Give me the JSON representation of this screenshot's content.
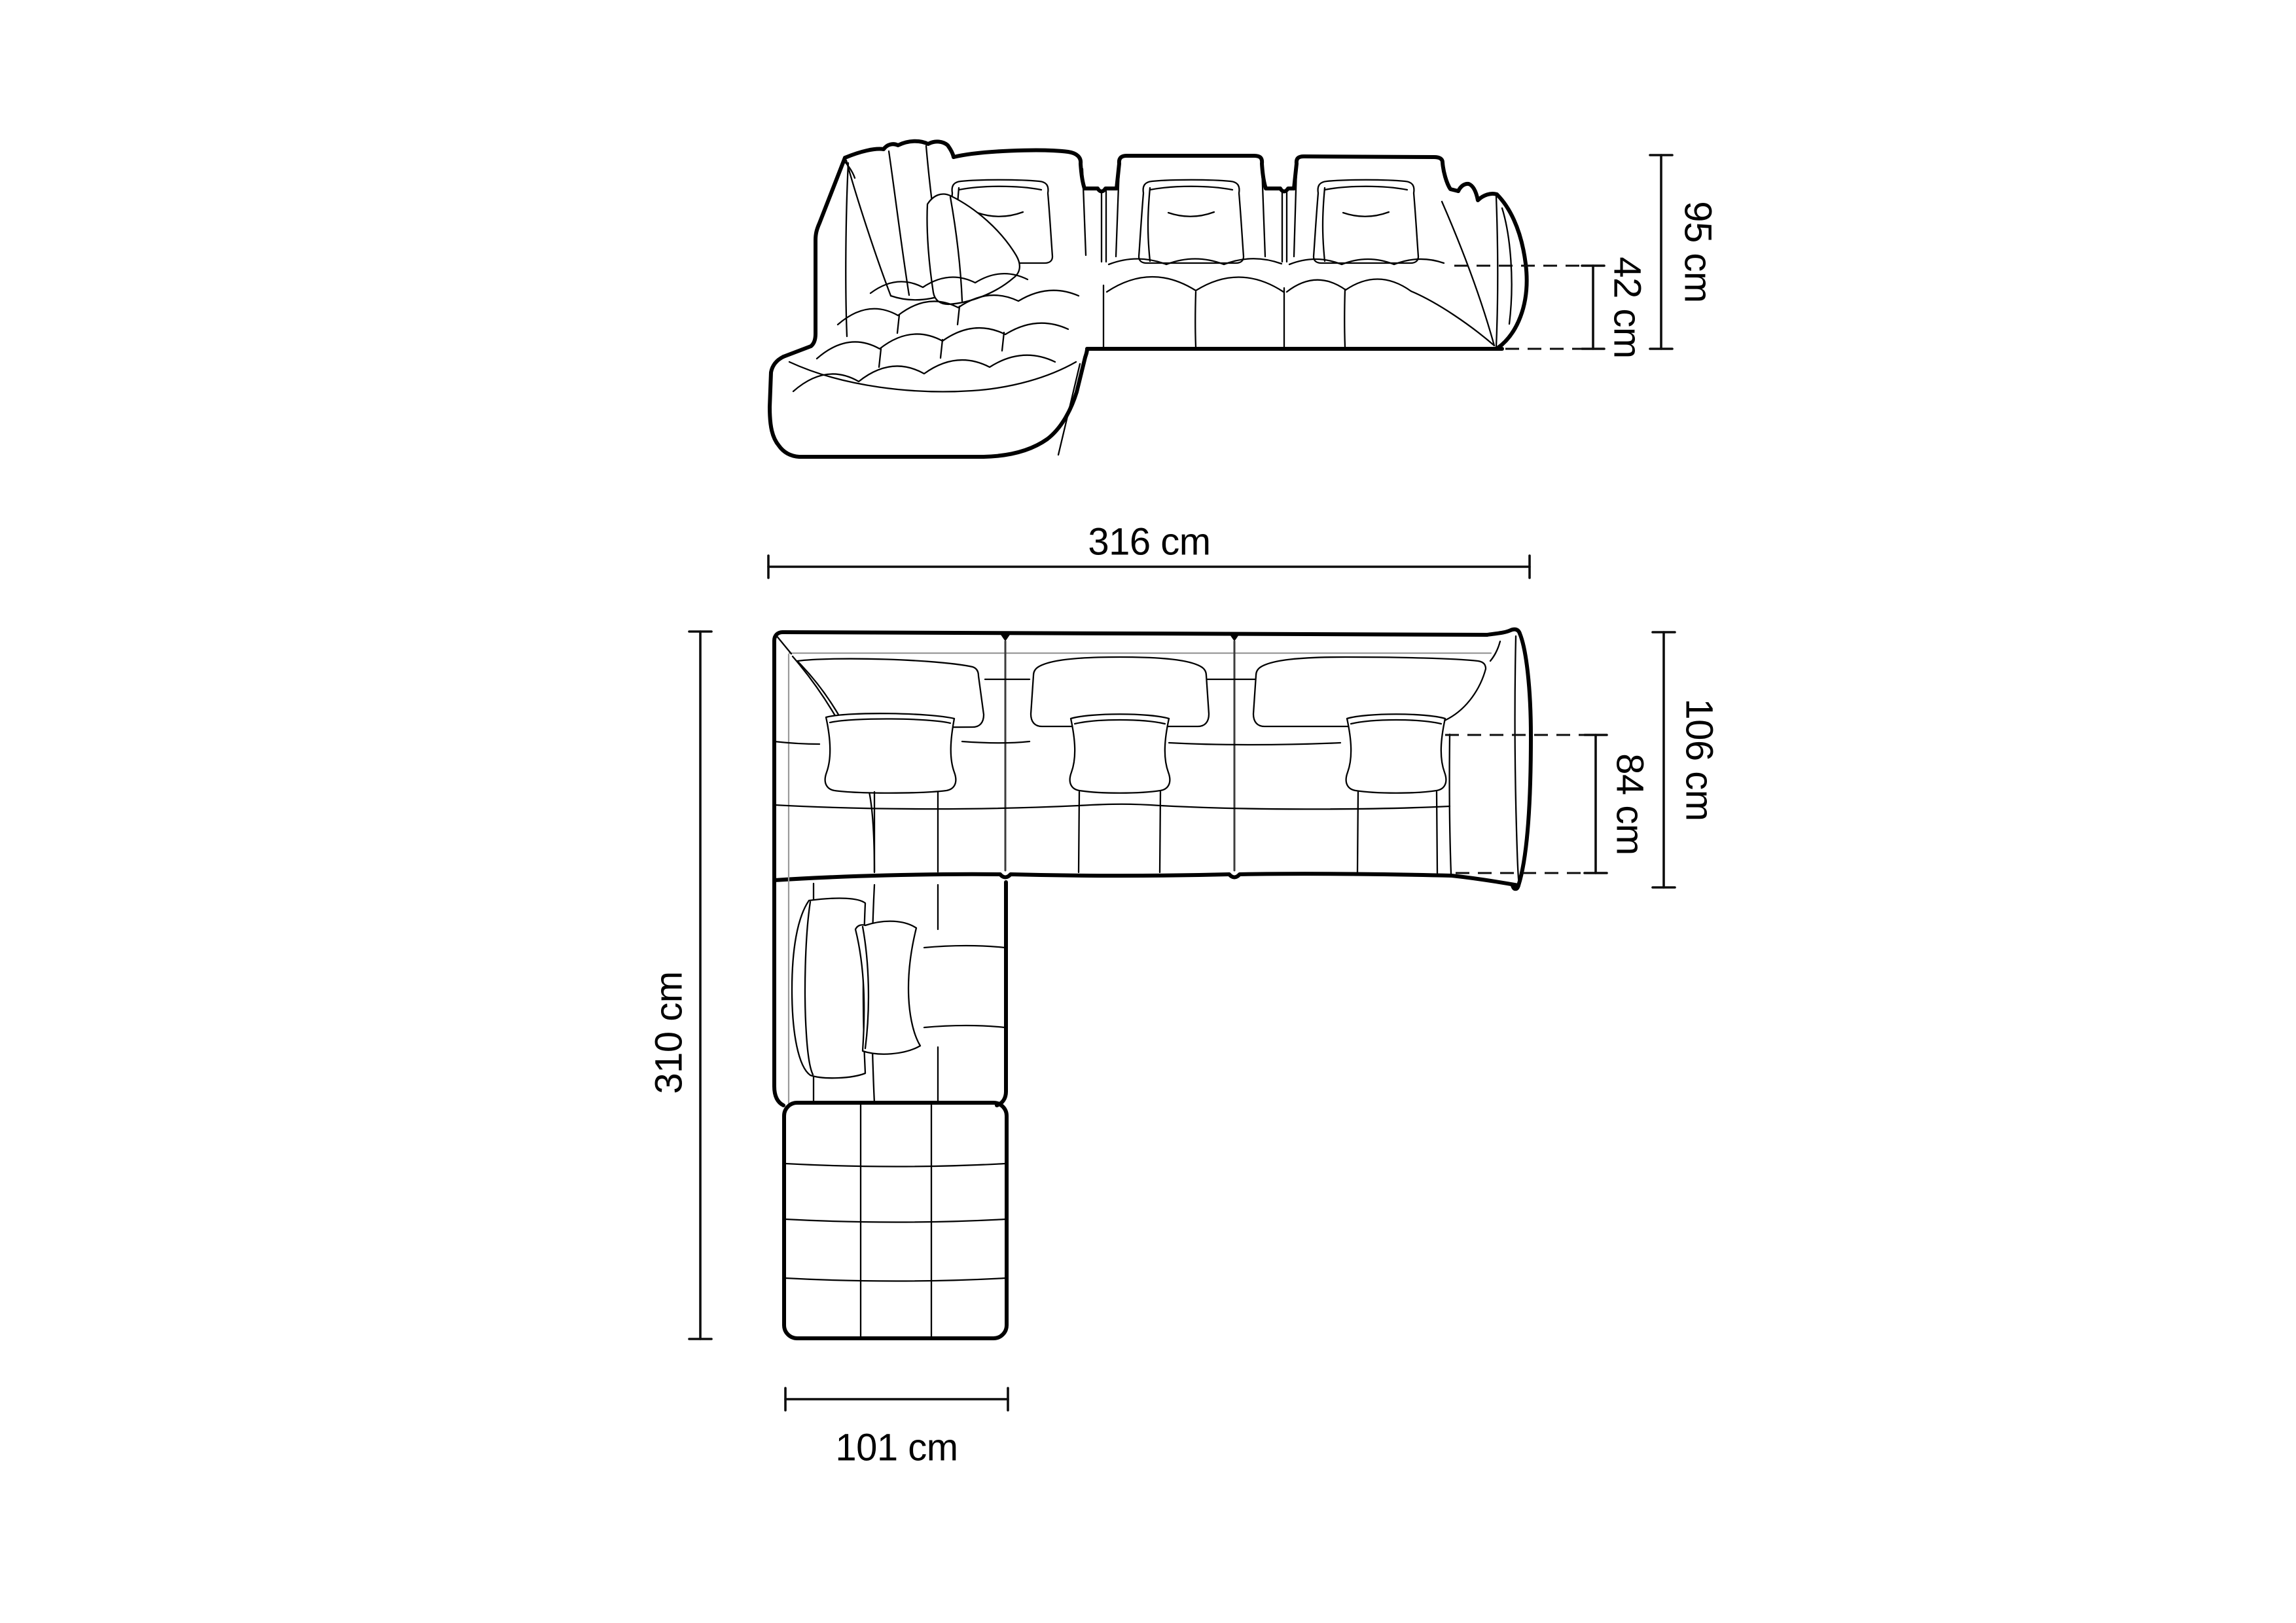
{
  "labels": {
    "front_height": "95 cm",
    "front_seat_height": "42 cm",
    "top_width": "316 cm",
    "top_depth": "106 cm",
    "top_seat_depth": "84 cm",
    "top_length": "310 cm",
    "top_chaise_width": "101 cm"
  },
  "colors": {
    "background": "#ffffff",
    "line": "#000000",
    "soft_line": "#9a9a9a",
    "dimension": "#0d0d0d"
  }
}
